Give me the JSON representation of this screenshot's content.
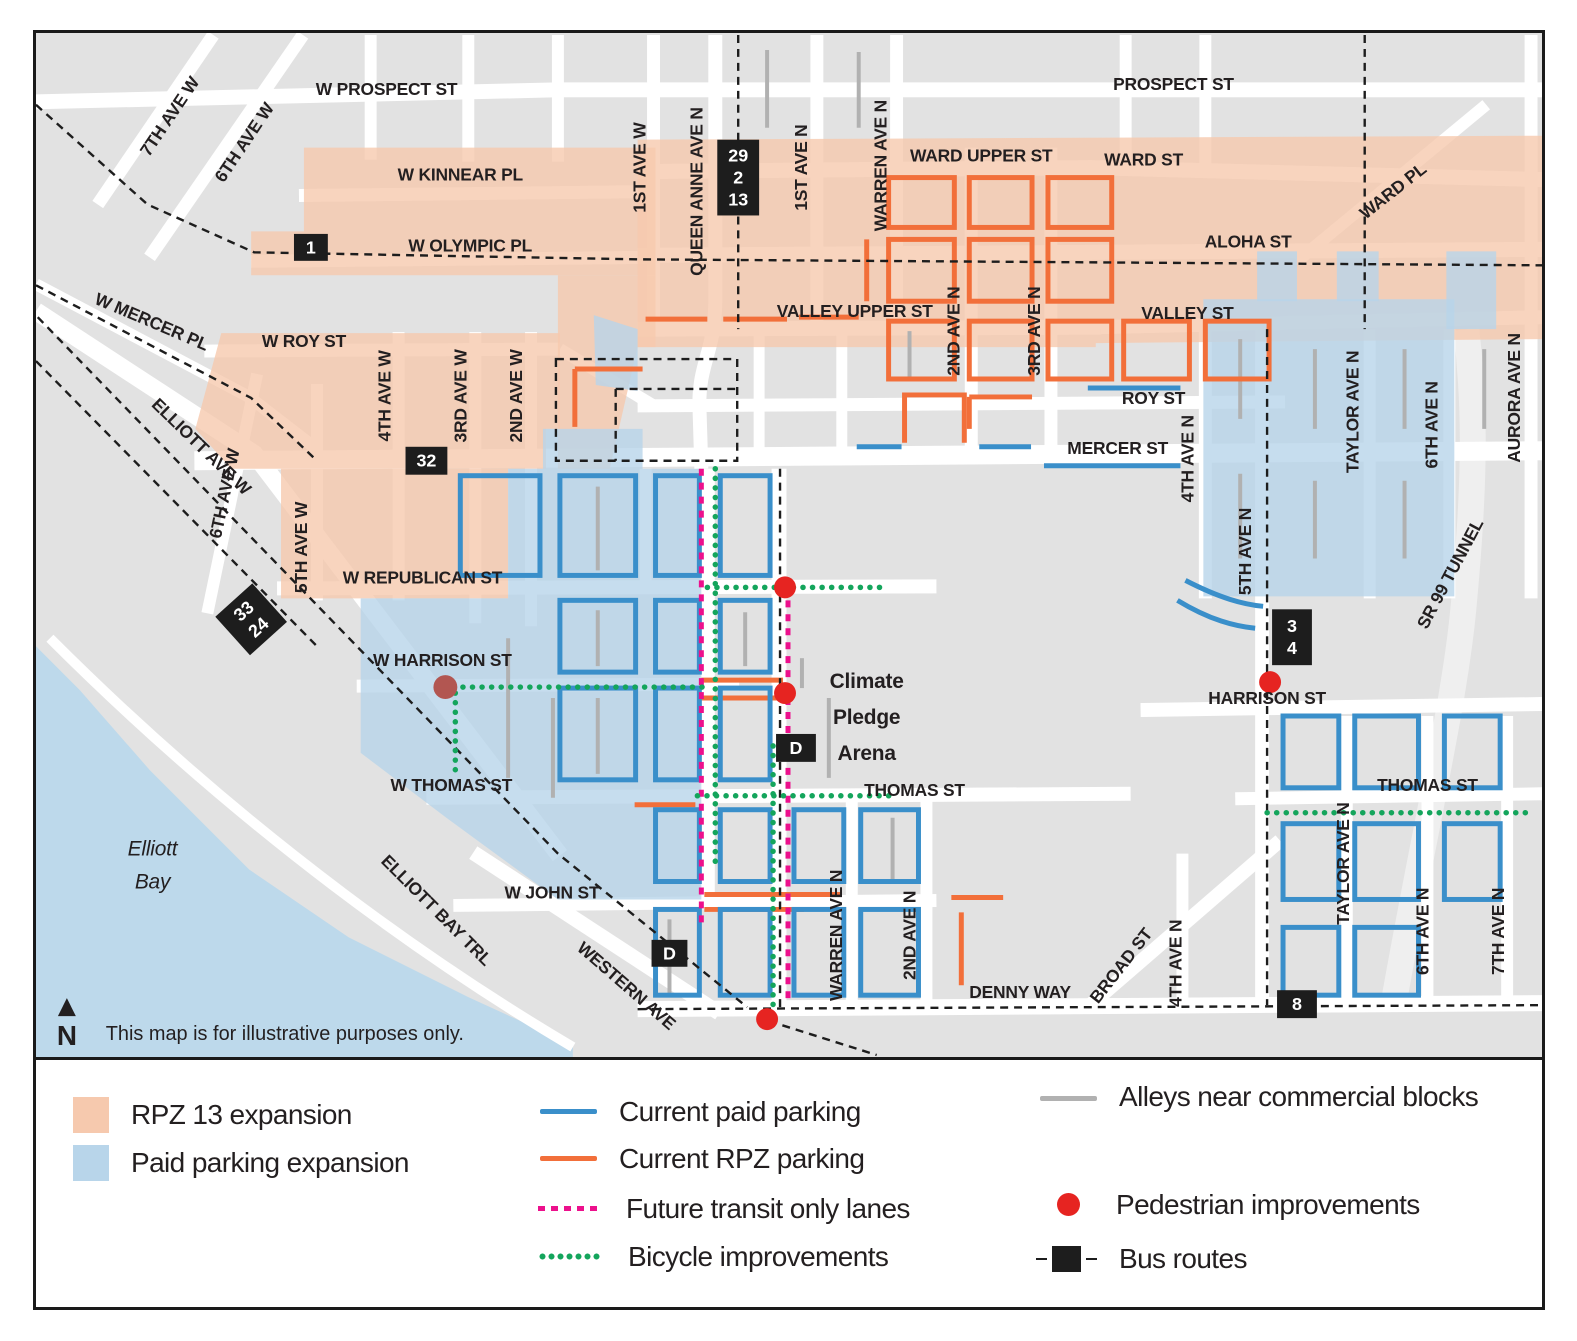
{
  "colors": {
    "rpz_fill": "#f6c9ae",
    "paid_fill": "#b8d5ea",
    "paid_line": "#3a8fca",
    "rpz_line": "#f26f3a",
    "transit": "#ec108c",
    "bike": "#14a55c",
    "alley": "#b1b1b1",
    "pedestrian": "#e62421",
    "pedestrian_dark": "#b25651",
    "bus": "#1d1d1d",
    "water": "#bdd9eb",
    "land": "#e2e2e2"
  },
  "map": {
    "north_label": "N",
    "labels": [
      {
        "t": "W PROSPECT ST",
        "x": 388,
        "y": 95
      },
      {
        "t": "PROSPECT ST",
        "x": 1178,
        "y": 90
      },
      {
        "t": "7TH AVE W",
        "x": 175,
        "y": 120,
        "r": -56
      },
      {
        "t": "6TH AVE W",
        "x": 250,
        "y": 146,
        "r": -56
      },
      {
        "t": "W KINNEAR PL",
        "x": 462,
        "y": 181
      },
      {
        "t": "W OLYMPIC PL",
        "x": 472,
        "y": 252
      },
      {
        "t": "WARD UPPER ST",
        "x": 985,
        "y": 162
      },
      {
        "t": "WARD ST",
        "x": 1148,
        "y": 166
      },
      {
        "t": "WARD PL",
        "x": 1402,
        "y": 196,
        "r": -38
      },
      {
        "t": "ALOHA ST",
        "x": 1253,
        "y": 248
      },
      {
        "t": "W MERCER PL",
        "x": 150,
        "y": 328,
        "r": 23
      },
      {
        "t": "ELLIOTT AVE W",
        "x": 198,
        "y": 452,
        "r": 44
      },
      {
        "t": "1ST AVE W",
        "x": 648,
        "y": 168,
        "r": -90
      },
      {
        "t": "QUEEN ANNE AVE N",
        "x": 705,
        "y": 192,
        "r": -90
      },
      {
        "t": "1ST AVE N",
        "x": 810,
        "y": 168,
        "r": -90
      },
      {
        "t": "WARREN AVE N",
        "x": 890,
        "y": 166,
        "r": -90
      },
      {
        "t": "VALLEY UPPER ST",
        "x": 858,
        "y": 318
      },
      {
        "t": "VALLEY ST",
        "x": 1192,
        "y": 320
      },
      {
        "t": "2ND AVE N",
        "x": 963,
        "y": 332,
        "r": -90
      },
      {
        "t": "3RD AVE N",
        "x": 1044,
        "y": 332,
        "r": -90
      },
      {
        "t": "W ROY ST",
        "x": 305,
        "y": 348
      },
      {
        "t": "ROY ST",
        "x": 1158,
        "y": 405
      },
      {
        "t": "MERCER ST",
        "x": 1122,
        "y": 455
      },
      {
        "t": "4TH AVE W",
        "x": 392,
        "y": 397,
        "r": -90
      },
      {
        "t": "3RD AVE W",
        "x": 468,
        "y": 397,
        "r": -90
      },
      {
        "t": "2ND AVE W",
        "x": 524,
        "y": 397,
        "r": -90
      },
      {
        "t": "4TH AVE N",
        "x": 1198,
        "y": 460,
        "r": -90
      },
      {
        "t": "5TH AVE N",
        "x": 1256,
        "y": 553,
        "r": -90
      },
      {
        "t": "TAYLOR AVE N",
        "x": 1364,
        "y": 413,
        "r": -90
      },
      {
        "t": "6TH AVE N",
        "x": 1443,
        "y": 426,
        "r": -90
      },
      {
        "t": "AURORA AVE N",
        "x": 1526,
        "y": 399,
        "r": -90
      },
      {
        "t": "SR 99 TUNNEL",
        "x": 1461,
        "y": 578,
        "r": -62
      },
      {
        "t": "6TH AVE W",
        "x": 231,
        "y": 496,
        "r": -78
      },
      {
        "t": "5TH AVE W",
        "x": 308,
        "y": 549,
        "r": -90
      },
      {
        "t": "W REPUBLICAN ST",
        "x": 424,
        "y": 585
      },
      {
        "t": "W HARRISON ST",
        "x": 444,
        "y": 668
      },
      {
        "t": "HARRISON ST",
        "x": 1272,
        "y": 706
      },
      {
        "t": "W THOMAS ST",
        "x": 453,
        "y": 793
      },
      {
        "t": "THOMAS ST",
        "x": 918,
        "y": 798
      },
      {
        "t": "THOMAS ST",
        "x": 1433,
        "y": 793
      },
      {
        "t": "TAYLOR AVE N",
        "x": 1354,
        "y": 866,
        "r": -90
      },
      {
        "t": "W JOHN ST",
        "x": 554,
        "y": 901
      },
      {
        "t": "WESTERN AVE",
        "x": 625,
        "y": 993,
        "r": 41
      },
      {
        "t": "ELLIOTT BAY TRL",
        "x": 434,
        "y": 917,
        "r": 45
      },
      {
        "t": "WARREN AVE N",
        "x": 845,
        "y": 938,
        "r": -90
      },
      {
        "t": "2ND AVE N",
        "x": 919,
        "y": 938,
        "r": -90
      },
      {
        "t": "DENNY WAY",
        "x": 1024,
        "y": 1001
      },
      {
        "t": "BROAD ST",
        "x": 1130,
        "y": 972,
        "r": -52
      },
      {
        "t": "4TH AVE N",
        "x": 1186,
        "y": 966,
        "r": -90
      },
      {
        "t": "6TH AVE N",
        "x": 1434,
        "y": 934,
        "r": -90
      },
      {
        "t": "7TH AVE N",
        "x": 1510,
        "y": 934,
        "r": -90
      },
      {
        "lines": [
          "Climate",
          "Pledge",
          "Arena"
        ],
        "x": 870,
        "y": 690,
        "cls": "lbl-arena",
        "lh": 36,
        "name": "arena-label"
      },
      {
        "lines": [
          "Elliott",
          "Bay"
        ],
        "x": 153,
        "y": 858,
        "cls": "lbl-bay",
        "lh": 33,
        "name": "water-label"
      },
      {
        "t": "This map is for illustrative purposes only.",
        "x": 106,
        "y": 1043,
        "cls": "lbl-disclaimer",
        "name": "disclaimer-text"
      }
    ],
    "bus_badges": [
      {
        "lines": [
          "1"
        ],
        "x": 312,
        "y": 248,
        "w": 34,
        "h": 27
      },
      {
        "lines": [
          "29",
          "2",
          "13"
        ],
        "x": 741,
        "y": 178,
        "w": 42,
        "h": 76
      },
      {
        "lines": [
          "32"
        ],
        "x": 428,
        "y": 462,
        "w": 42,
        "h": 28
      },
      {
        "lines": [
          "33",
          "24"
        ],
        "x": 252,
        "y": 621,
        "w": 50,
        "h": 52,
        "r": -42
      },
      {
        "lines": [
          "3",
          "4"
        ],
        "x": 1297,
        "y": 639,
        "w": 40,
        "h": 56
      },
      {
        "lines": [
          "D"
        ],
        "x": 799,
        "y": 750,
        "w": 40,
        "h": 28
      },
      {
        "lines": [
          "D"
        ],
        "x": 672,
        "y": 956,
        "w": 36,
        "h": 27
      },
      {
        "lines": [
          "8"
        ],
        "x": 1302,
        "y": 1007,
        "w": 40,
        "h": 28
      }
    ],
    "pedestrian_dots": [
      {
        "x": 788,
        "y": 589,
        "r": 11
      },
      {
        "x": 788,
        "y": 695,
        "r": 11
      },
      {
        "x": 770,
        "y": 1022,
        "r": 11
      },
      {
        "x": 1275,
        "y": 684,
        "r": 11
      },
      {
        "x": 447,
        "y": 689,
        "r": 12,
        "dark": true
      }
    ]
  },
  "legend": {
    "rpz13": "RPZ 13 expansion",
    "paid_expansion": "Paid parking expansion",
    "current_paid": "Current paid parking",
    "current_rpz": "Current RPZ parking",
    "transit_lanes": "Future transit only lanes",
    "bike": "Bicycle improvements",
    "alleys": "Alleys near commercial blocks",
    "pedestrian": "Pedestrian improvements",
    "bus_routes": "Bus routes"
  }
}
